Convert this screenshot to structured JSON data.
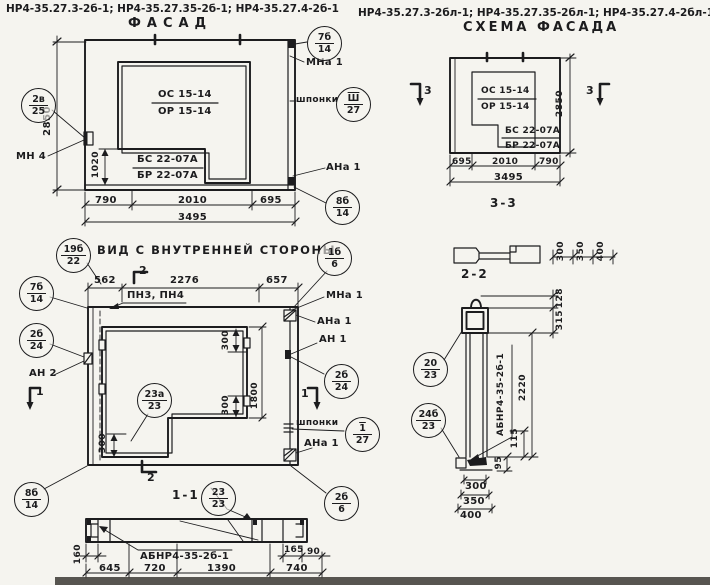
{
  "page": {
    "background": "#f5f4ef",
    "ink": "#1c1c1e"
  },
  "headers": {
    "left_codes": "НР4-35.27.3-2б-1; НР4-35.27.35-2б-1; НР4-35.27.4-2б-1",
    "facade_title": "ФАСАД",
    "right_codes": "НР4-35.27.3-2бл-1; НР4-35.27.35-2бл-1; НР4-35.27.4-2бл-1",
    "scheme_title": "СХЕМА ФАСАДА"
  },
  "facade": {
    "window_mark_top": "ОС 15-14",
    "window_mark_bottom": "ОР 15-14",
    "panel_mark_top": "БС 22-07А",
    "panel_mark_bottom": "БР 22-07А",
    "anchor_mn4": "МН 4",
    "anchor_mna1": "МНа 1",
    "keys_label": "шпонки",
    "anchor_ana1": "АНа 1",
    "callout_mn": {
      "num": "2в",
      "sheet": "25"
    },
    "callout_top_right": {
      "num": "7б",
      "sheet": "14"
    },
    "callout_keys": {
      "num": "Ш",
      "sheet": "27"
    },
    "callout_bottom_right": {
      "num": "8б",
      "sheet": "14"
    },
    "dim_height": "2850",
    "dim_sill": "1020",
    "dims_bottom": [
      "790",
      "2010",
      "695"
    ],
    "dim_total": "3495"
  },
  "scheme": {
    "window_mark_top": "ОС 15-14",
    "window_mark_bottom": "ОР 15-14",
    "panel_mark_top": "БС 22-07А",
    "panel_mark_bottom": "БР 22-07А",
    "section_mark": "3",
    "dim_height": "2850",
    "dims_bottom": [
      "695",
      "2010",
      "790"
    ],
    "dim_total": "3495",
    "section33_title": "3-3",
    "section33_dims": [
      "300",
      "350",
      "400"
    ]
  },
  "inner_view": {
    "title": "ВИД С ВНУТРЕННЕЙ СТОРОНЫ",
    "dims_top": [
      "562",
      "2276",
      "657"
    ],
    "rails_label": "ПН3, ПН4",
    "section2_mark": "2",
    "section1_mark": "1",
    "anchor_mna1": "МНа 1",
    "anchor_ana1_top": "АНа 1",
    "anchor_an1": "АН 1",
    "anchor_an2": "АН 2",
    "keys_label": "шпонки",
    "anchor_ana1_bottom": "АНа 1",
    "callout_top_left": {
      "num": "19б",
      "sheet": "22"
    },
    "callout_left_upper": {
      "num": "7б",
      "sheet": "14"
    },
    "callout_top_right": {
      "num": "1б",
      "sheet": "6"
    },
    "callout_left_lower": {
      "num": "2б",
      "sheet": "24"
    },
    "callout_right": {
      "num": "2б",
      "sheet": "24"
    },
    "callout_window": {
      "num": "23а",
      "sheet": "23"
    },
    "callout_keys": {
      "num": "1",
      "sheet": "27"
    },
    "callout_bottom_left": {
      "num": "8б",
      "sheet": "14"
    },
    "callout_bottom_right": {
      "num": "2б",
      "sheet": "6"
    },
    "dim_win_top": "300",
    "dim_win_mid": "300",
    "dim_win_height": "1800",
    "dim_leg": "300"
  },
  "section_1_1": {
    "title": "1-1",
    "callout": {
      "num": "23",
      "sheet": "23"
    },
    "part_label": "АБНР4-35-2б-1",
    "dim_left": "160",
    "dim_165": "165",
    "dim_90": "90",
    "dims_bottom": [
      "645",
      "720",
      "1390",
      "740"
    ]
  },
  "section_2_2": {
    "title": "2-2",
    "callout_upper": {
      "num": "20",
      "sheet": "23"
    },
    "callout_lower": {
      "num": "24б",
      "sheet": "23"
    },
    "part_label": "АБНР4-35-2б-1",
    "dim_128": "128",
    "dim_315": "315",
    "dim_2220": "2220",
    "dim_115": "115",
    "dim_95": "95",
    "dims_bottom": [
      "300",
      "350",
      "400"
    ]
  }
}
